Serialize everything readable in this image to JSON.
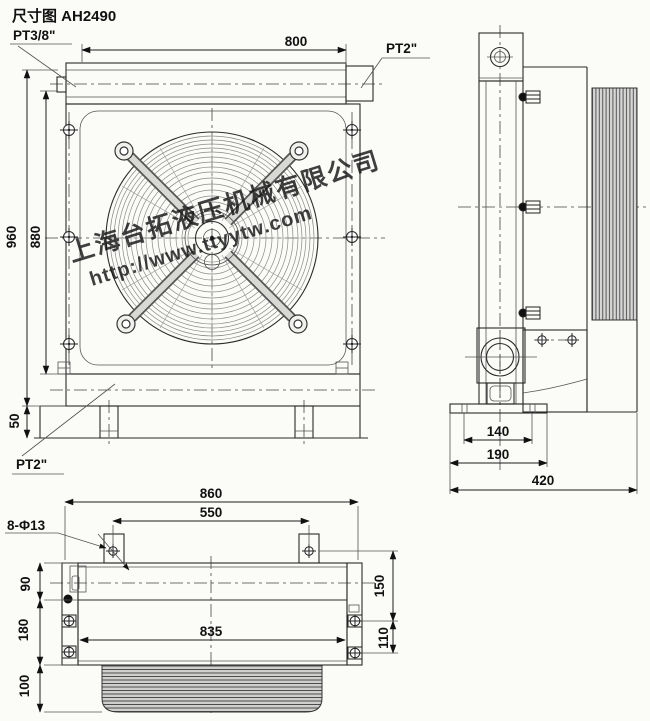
{
  "title": "尺寸图 AH2490",
  "watermark": {
    "company": "上海台拓液压机械有限公司",
    "url": "http://www.ttyytw.com",
    "color": "#3f5be0"
  },
  "colors": {
    "line": "#2b2b2b",
    "background": "#fbfbf8",
    "hatch_fill": "#d3d3d1"
  },
  "front_view": {
    "port_top_left_label": "PT3/8\"",
    "port_top_right_label": "PT2\"",
    "port_bottom_left_label": "PT2\"",
    "dim_top_width": "800",
    "dim_overall_height": "960",
    "dim_core_height": "880",
    "dim_base_height": "50"
  },
  "side_view": {
    "dim_foot_holes": "140",
    "dim_foot_width": "190",
    "dim_overall_depth": "420"
  },
  "bottom_view": {
    "holes_callout": "8-Φ13",
    "dim_overall_width": "860",
    "dim_tab_spacing": "550",
    "dim_core_width": "835",
    "dim_left_top": "90",
    "dim_left_middle": "180",
    "dim_left_bottom": "100",
    "dim_right_top": "150",
    "dim_right_middle": "110"
  }
}
